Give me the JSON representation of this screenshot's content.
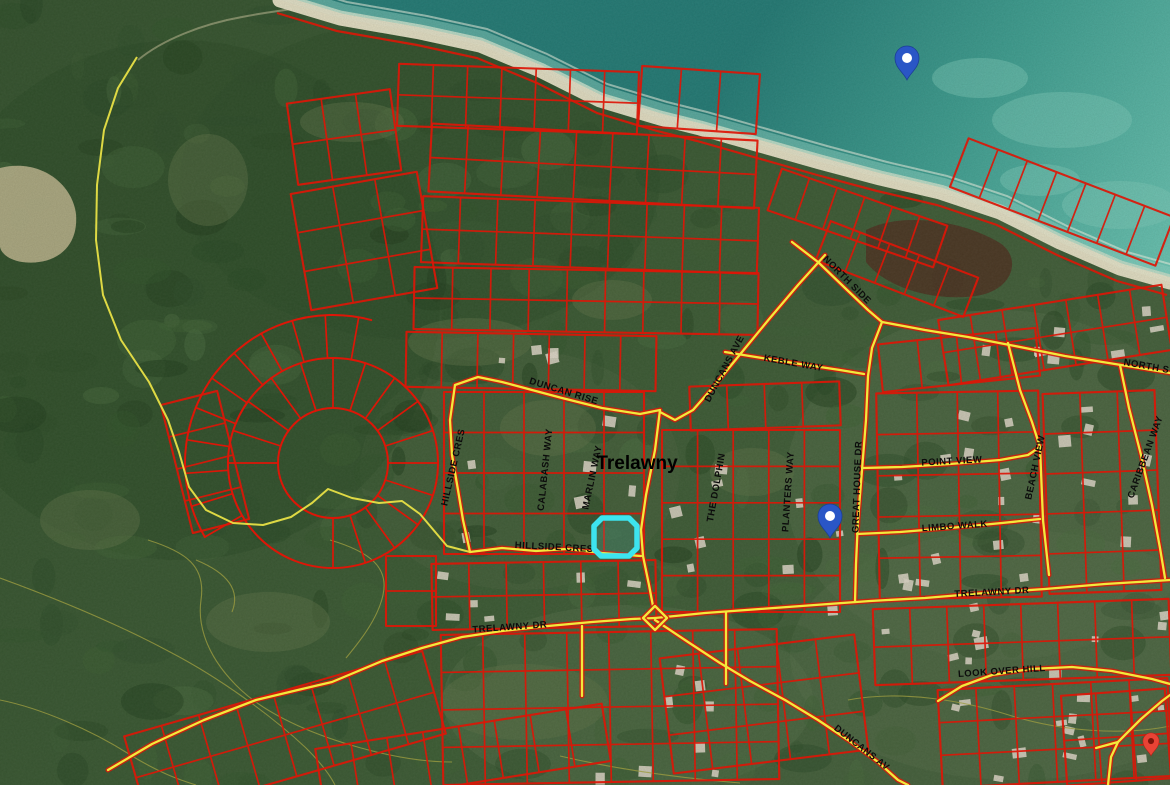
{
  "map": {
    "town_label": {
      "text": "Trelawny",
      "x": 637,
      "y": 469,
      "size": 19
    },
    "street_labels": [
      {
        "text": "DUNCAN RISE",
        "x": 563,
        "y": 394,
        "rot": 17
      },
      {
        "text": "DUNCANS AVE",
        "x": 727,
        "y": 370,
        "rot": -62
      },
      {
        "text": "KEBLE WAY",
        "x": 793,
        "y": 366,
        "rot": 10
      },
      {
        "text": "NORTH SIDE",
        "x": 845,
        "y": 282,
        "rot": 45
      },
      {
        "text": "NORTH S",
        "x": 1146,
        "y": 369,
        "rot": 10
      },
      {
        "text": "HILLSIDE CRES",
        "x": 456,
        "y": 468,
        "rot": -77
      },
      {
        "text": "CALABASH WAY",
        "x": 548,
        "y": 470,
        "rot": -84
      },
      {
        "text": "MARLIN WAY",
        "x": 595,
        "y": 478,
        "rot": -78
      },
      {
        "text": "HILLSIDE CRES",
        "x": 554,
        "y": 550,
        "rot": 3
      },
      {
        "text": "THE DOLPHIN",
        "x": 719,
        "y": 488,
        "rot": -80
      },
      {
        "text": "PLANTERS WAY",
        "x": 791,
        "y": 492,
        "rot": -86
      },
      {
        "text": "GREAT HOUSE DR",
        "x": 860,
        "y": 487,
        "rot": -88
      },
      {
        "text": "POINT VIEW",
        "x": 952,
        "y": 464,
        "rot": -3
      },
      {
        "text": "LIMBO WALK",
        "x": 955,
        "y": 529,
        "rot": -4
      },
      {
        "text": "BEACH VIEW",
        "x": 1038,
        "y": 468,
        "rot": -78
      },
      {
        "text": "CARIBBEAN WAY",
        "x": 1148,
        "y": 458,
        "rot": -70
      },
      {
        "text": "TRELAWNY DR",
        "x": 510,
        "y": 630,
        "rot": -4
      },
      {
        "text": "TRELAWNY DR",
        "x": 992,
        "y": 595,
        "rot": -3
      },
      {
        "text": "LOOK OVER HILL",
        "x": 1002,
        "y": 674,
        "rot": -4
      },
      {
        "text": "DUNCANS AV",
        "x": 860,
        "y": 750,
        "rot": 38
      }
    ],
    "markers": [
      {
        "kind": "blue-pin",
        "tip_x": 907,
        "tip_y": 80
      },
      {
        "kind": "blue-pin",
        "tip_x": 830,
        "tip_y": 538
      },
      {
        "kind": "red-pin",
        "tip_x": 1151,
        "tip_y": 756
      }
    ],
    "highlight_parcel": {
      "points": "594,526 602,518 629,518 637,526 637,548 629,556 601,556 594,549"
    }
  },
  "colors": {
    "parcel_line": "#dd1607",
    "road_fill": "#f2e93c",
    "road_casing": "#cf1d0c",
    "boundary_yellow": "#e8e046",
    "contour": "#9b9b40",
    "label": "#0c0c0c",
    "highlight": "#3de4ef",
    "marker_blue": "#2a56c6",
    "marker_red": "#e94335",
    "marker_red_inner": "#7e150b",
    "ocean_deep": "#257a74",
    "ocean_mid": "#3f9c8e",
    "ocean_shallow": "#6cc3b1",
    "sand": "#e7e0c6",
    "surf": "#eef3e2",
    "shallow_band": "#8ed2c2",
    "land_dark": "#35522e",
    "land_mid": "#3c5a34",
    "land_light": "#4a6340",
    "wetland": "#b2ad86",
    "marsh": "#4e3322",
    "house": "#d8d2c2",
    "forest_palette": [
      "#24401f",
      "#2b4a26",
      "#33552c",
      "#3f6135",
      "#4a6b3f",
      "#2e4d2a"
    ]
  },
  "geometry": {
    "ocean_coast": [
      [
        280,
        0
      ],
      [
        340,
        18
      ],
      [
        420,
        32
      ],
      [
        480,
        45
      ],
      [
        540,
        70
      ],
      [
        600,
        100
      ],
      [
        660,
        118
      ],
      [
        700,
        128
      ],
      [
        760,
        145
      ],
      [
        820,
        162
      ],
      [
        880,
        178
      ],
      [
        940,
        192
      ],
      [
        1000,
        212
      ],
      [
        1060,
        242
      ],
      [
        1120,
        268
      ],
      [
        1170,
        282
      ]
    ],
    "reefs": [
      [
        1062,
        120,
        70,
        28
      ],
      [
        980,
        78,
        48,
        20
      ],
      [
        1120,
        205,
        58,
        24
      ],
      [
        1040,
        180,
        40,
        16
      ]
    ],
    "wetland_path": "M0,168 C38,158 72,182 76,214 C79,250 52,266 22,262 C8,260 0,252 0,246 Z",
    "marsh_path": "M866,230 C898,213 958,218 1000,243 C1022,258 1014,290 976,296 C930,302 884,286 866,262 Z",
    "trail_path": "M138,60 C162,40 202,24 242,17 C262,13 278,11 292,9",
    "clearings": [
      [
        470,
        342,
        62,
        24
      ],
      [
        548,
        428,
        48,
        28
      ],
      [
        612,
        300,
        40,
        20
      ],
      [
        352,
        122,
        52,
        20
      ],
      [
        752,
        472,
        42,
        24
      ],
      [
        268,
        622,
        62,
        30
      ],
      [
        524,
        702,
        84,
        38
      ],
      [
        208,
        180,
        40,
        46
      ],
      [
        90,
        520,
        50,
        30
      ]
    ],
    "soft_patches": [
      [
        1000,
        485,
        215,
        175,
        "#566d49"
      ],
      [
        1015,
        655,
        225,
        125,
        "#566d49"
      ],
      [
        628,
        700,
        185,
        95,
        "#56704b"
      ],
      [
        520,
        470,
        160,
        120,
        "#4c6540"
      ],
      [
        180,
        300,
        260,
        260,
        "#2c4a27"
      ],
      [
        420,
        180,
        240,
        160,
        "#2e4d29"
      ]
    ],
    "contours": [
      "M0,578 C60,600 120,625 170,652 C220,678 272,716 306,748 C322,764 330,775 335,785",
      "M0,700 C40,708 92,730 132,756 C162,774 180,780 196,785",
      "M148,540 C186,552 206,566 201,600 C197,628 209,660 241,690 C271,718 321,737 361,748 C401,759 431,762 452,762",
      "M330,540 C371,552 389,568 383,595 C378,618 361,640 346,658",
      "M848,700 C900,690 962,700 1012,716 C1062,731 1122,736 1170,726",
      "M560,756 C620,770 680,778 740,783",
      "M196,560 C230,574 240,592 232,612"
    ],
    "blocks": [
      [
        398,
        68,
        240,
        62,
        2,
        7,
        2
      ],
      [
        292,
        96,
        104,
        82,
        2,
        3,
        -8
      ],
      [
        640,
        70,
        118,
        60,
        1,
        3,
        4
      ],
      [
        300,
        182,
        128,
        118,
        3,
        3,
        -10
      ],
      [
        430,
        132,
        326,
        68,
        2,
        9,
        3
      ],
      [
        422,
        202,
        336,
        66,
        2,
        9,
        2
      ],
      [
        414,
        270,
        344,
        62,
        2,
        9,
        1
      ],
      [
        406,
        334,
        250,
        55,
        1,
        7,
        1
      ],
      [
        770,
        196,
        175,
        44,
        1,
        6,
        19
      ],
      [
        818,
        248,
        158,
        42,
        1,
        5,
        21
      ],
      [
        952,
        176,
        220,
        52,
        1,
        7,
        21
      ],
      [
        444,
        392,
        200,
        162,
        4,
        5,
        0
      ],
      [
        432,
        562,
        224,
        66,
        2,
        6,
        -1
      ],
      [
        662,
        430,
        178,
        182,
        5,
        5,
        0
      ],
      [
        690,
        384,
        150,
        44,
        1,
        4,
        -2
      ],
      [
        878,
        392,
        162,
        206,
        5,
        4,
        -1
      ],
      [
        1046,
        392,
        112,
        200,
        5,
        3,
        -2
      ],
      [
        942,
        302,
        226,
        66,
        2,
        7,
        -9
      ],
      [
        880,
        336,
        158,
        48,
        1,
        4,
        -6
      ],
      [
        874,
        604,
        296,
        76,
        2,
        8,
        -2
      ],
      [
        940,
        684,
        230,
        98,
        3,
        6,
        -3
      ],
      [
        442,
        632,
        336,
        150,
        4,
        8,
        -1
      ],
      [
        666,
        646,
        196,
        116,
        3,
        5,
        -7
      ],
      [
        176,
        396,
        58,
        132,
        4,
        1,
        -14
      ],
      [
        386,
        556,
        50,
        70,
        2,
        1,
        0
      ],
      [
        1064,
        692,
        104,
        90,
        2,
        3,
        -4
      ],
      [
        130,
        692,
        310,
        86,
        2,
        8,
        -16
      ],
      [
        318,
        726,
        290,
        58,
        1,
        8,
        -9
      ]
    ],
    "crescent": {
      "cx": 333,
      "cy": 463,
      "r_inner": 55,
      "r_outer": 105,
      "spoke_step": 18,
      "spoke_gap": [
        100,
        170
      ],
      "fan_r": 148,
      "fan_range": [
        150,
        285
      ],
      "fan_step": 13
    },
    "roads_boundary": [
      [
        [
          137,
          57
        ],
        [
          118,
          88
        ],
        [
          104,
          130
        ],
        [
          97,
          185
        ],
        [
          96,
          240
        ],
        [
          103,
          295
        ],
        [
          121,
          340
        ],
        [
          149,
          382
        ],
        [
          168,
          420
        ],
        [
          179,
          452
        ],
        [
          189,
          487
        ],
        [
          206,
          510
        ],
        [
          233,
          523
        ],
        [
          263,
          525
        ],
        [
          291,
          517
        ],
        [
          312,
          503
        ],
        [
          328,
          489
        ],
        [
          352,
          498
        ],
        [
          379,
          503
        ],
        [
          402,
          501
        ],
        [
          420,
          514
        ],
        [
          447,
          546
        ],
        [
          470,
          552
        ]
      ]
    ],
    "roads_main": [
      [
        [
          470,
          552
        ],
        [
          502,
          548
        ],
        [
          536,
          551
        ],
        [
          567,
          549
        ],
        [
          602,
          553
        ],
        [
          641,
          556
        ]
      ],
      [
        [
          660,
          410
        ],
        [
          655,
          450
        ],
        [
          646,
          495
        ],
        [
          641,
          530
        ],
        [
          643,
          556
        ],
        [
          649,
          585
        ],
        [
          653,
          606
        ]
      ],
      [
        [
          455,
          385
        ],
        [
          478,
          377
        ],
        [
          502,
          382
        ],
        [
          532,
          390
        ],
        [
          562,
          398
        ],
        [
          602,
          408
        ],
        [
          640,
          414
        ],
        [
          660,
          410
        ]
      ],
      [
        [
          455,
          385
        ],
        [
          450,
          420
        ],
        [
          452,
          455
        ],
        [
          458,
          490
        ],
        [
          463,
          520
        ],
        [
          470,
          552
        ]
      ],
      [
        [
          825,
          255
        ],
        [
          798,
          285
        ],
        [
          770,
          318
        ],
        [
          742,
          352
        ],
        [
          715,
          385
        ],
        [
          693,
          410
        ],
        [
          675,
          420
        ],
        [
          660,
          412
        ]
      ],
      [
        [
          792,
          242
        ],
        [
          818,
          262
        ],
        [
          845,
          288
        ],
        [
          868,
          310
        ],
        [
          882,
          322
        ]
      ],
      [
        [
          882,
          322
        ],
        [
          925,
          330
        ],
        [
          968,
          337
        ],
        [
          1015,
          346
        ],
        [
          1065,
          356
        ],
        [
          1115,
          364
        ],
        [
          1170,
          373
        ]
      ],
      [
        [
          725,
          352
        ],
        [
          762,
          358
        ],
        [
          800,
          364
        ],
        [
          840,
          370
        ],
        [
          864,
          374
        ]
      ],
      [
        [
          882,
          322
        ],
        [
          872,
          348
        ],
        [
          868,
          376
        ],
        [
          866,
          420
        ],
        [
          862,
          470
        ],
        [
          858,
          520
        ],
        [
          856,
          564
        ],
        [
          855,
          602
        ]
      ],
      [
        [
          862,
          468
        ],
        [
          902,
          467
        ],
        [
          950,
          464
        ],
        [
          1000,
          460
        ],
        [
          1028,
          455
        ],
        [
          1040,
          447
        ]
      ],
      [
        [
          857,
          534
        ],
        [
          900,
          532
        ],
        [
          950,
          528
        ],
        [
          1002,
          523
        ],
        [
          1040,
          519
        ]
      ],
      [
        [
          1008,
          343
        ],
        [
          1020,
          390
        ],
        [
          1032,
          422
        ],
        [
          1040,
          447
        ],
        [
          1043,
          520
        ],
        [
          1049,
          575
        ]
      ],
      [
        [
          1120,
          365
        ],
        [
          1129,
          408
        ],
        [
          1141,
          455
        ],
        [
          1152,
          505
        ],
        [
          1160,
          548
        ],
        [
          1165,
          578
        ]
      ],
      [
        [
          582,
          626
        ],
        [
          582,
          696
        ]
      ],
      [
        [
          726,
          612
        ],
        [
          726,
          684
        ]
      ],
      [
        [
          938,
          701
        ],
        [
          962,
          686
        ],
        [
          992,
          675
        ],
        [
          1030,
          669
        ],
        [
          1072,
          667
        ],
        [
          1112,
          671
        ],
        [
          1152,
          679
        ],
        [
          1170,
          684
        ]
      ],
      [
        [
          1108,
          785
        ],
        [
          1111,
          757
        ],
        [
          1118,
          742
        ],
        [
          1141,
          719
        ],
        [
          1162,
          701
        ],
        [
          1170,
          695
        ]
      ],
      [
        [
          1118,
          742
        ],
        [
          1096,
          748
        ]
      ],
      [
        [
          655,
          618
        ],
        [
          705,
          613
        ],
        [
          760,
          609
        ],
        [
          815,
          605
        ],
        [
          870,
          601
        ],
        [
          925,
          598
        ],
        [
          985,
          593
        ],
        [
          1045,
          589
        ],
        [
          1105,
          584
        ],
        [
          1170,
          580
        ]
      ],
      [
        [
          108,
          770
        ],
        [
          152,
          744
        ],
        [
          204,
          720
        ],
        [
          256,
          700
        ],
        [
          302,
          689
        ],
        [
          332,
          682
        ],
        [
          382,
          661
        ],
        [
          422,
          648
        ],
        [
          462,
          637
        ],
        [
          502,
          631
        ],
        [
          548,
          626
        ],
        [
          592,
          622
        ],
        [
          632,
          619
        ],
        [
          655,
          618
        ]
      ],
      [
        [
          655,
          620
        ],
        [
          688,
          642
        ],
        [
          720,
          663
        ],
        [
          750,
          681
        ],
        [
          785,
          700
        ],
        [
          818,
          720
        ],
        [
          848,
          740
        ],
        [
          878,
          762
        ],
        [
          898,
          780
        ],
        [
          908,
          785
        ]
      ]
    ],
    "roundabout": [
      [
        655,
        606
      ],
      [
        667,
        618
      ],
      [
        655,
        630
      ],
      [
        643,
        618
      ]
    ],
    "house_regions": [
      [
        880,
        398,
        155,
        190,
        14
      ],
      [
        945,
        306,
        210,
        50,
        8
      ],
      [
        664,
        434,
        172,
        170,
        9
      ],
      [
        878,
        604,
        288,
        66,
        10
      ],
      [
        1050,
        397,
        100,
        185,
        8
      ],
      [
        436,
        566,
        212,
        56,
        6
      ],
      [
        570,
        634,
        200,
        140,
        8
      ],
      [
        942,
        690,
        220,
        85,
        8
      ],
      [
        440,
        397,
        210,
        150,
        6
      ],
      [
        1060,
        694,
        100,
        80,
        5
      ],
      [
        470,
        330,
        120,
        40,
        4
      ]
    ]
  }
}
